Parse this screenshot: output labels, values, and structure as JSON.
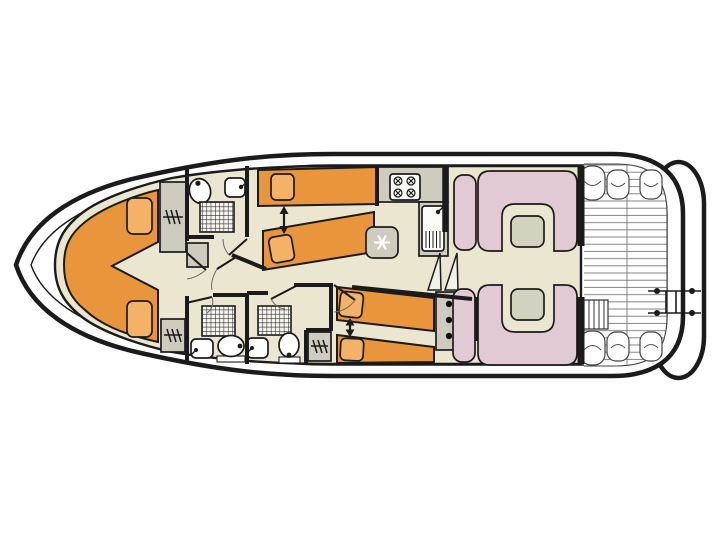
{
  "title": "motor-cruiser-deck-plan",
  "colors": {
    "outline": "#1b1b1b",
    "hull_fill": "#ffffff",
    "floor": "#EAE6D0",
    "deck": "#ffffff",
    "bed": "#E9953C",
    "pillow": "#F3B266",
    "furniture": "#CDCCBE",
    "appliance": "#FBFBF6",
    "seat": "#E2CAD5",
    "table": "#D3D2BE",
    "steps_fill": "#F2F1E8",
    "plank_line": "#777777",
    "snowflake": "#ffffff",
    "dot": "#111111"
  },
  "areas": {
    "bow_cabin": {
      "id": "bow-cabin",
      "fixtures": [
        "v-berth-double-bed",
        "pillow",
        "pillow",
        "wardrobe",
        "wardrobe",
        "step-cabinet"
      ]
    },
    "fore_bathroom": {
      "id": "fore-bathroom",
      "fixtures": [
        "toilet",
        "washbasin",
        "shower"
      ]
    },
    "port_mid_cabin": {
      "id": "port-mid-cabin",
      "fixtures": [
        "single-bed",
        "single-bed",
        "convertible-arrow"
      ]
    },
    "galley": {
      "id": "galley",
      "fixtures": [
        "four-burner-stove",
        "sink-with-drainer",
        "fridge-freezer",
        "worktop"
      ]
    },
    "aft_bathroom_port": {
      "id": "aft-bathroom-1",
      "fixtures": [
        "shower",
        "washbasin",
        "toilet"
      ]
    },
    "aft_bathroom_starboard": {
      "id": "aft-bathroom-2",
      "fixtures": [
        "shower",
        "washbasin",
        "toilet",
        "wardrobe"
      ]
    },
    "starboard_aft_cabin": {
      "id": "starboard-aft-cabin",
      "fixtures": [
        "single-bed",
        "single-bed",
        "convertible-arrow"
      ]
    },
    "helm": {
      "id": "helm-station",
      "fixtures": [
        "companionway-steps",
        "control-console",
        "steering-wheel"
      ]
    },
    "saloon": {
      "id": "saloon",
      "fixtures": [
        "u-shaped-dinette",
        "table",
        "u-shaped-dinette",
        "table"
      ]
    },
    "aft_deck": {
      "id": "aft-deck",
      "fixtures": [
        "plank-decking",
        "corner-seat",
        "corner-seat",
        "corner-seat",
        "corner-seat",
        "corner-seat",
        "corner-seat",
        "boarding-steps"
      ]
    },
    "swim_platform": {
      "id": "swim-platform",
      "fixtures": [
        "boarding-ladder"
      ]
    }
  },
  "icons": [
    "snowflake-icon",
    "stove-burner-icon",
    "wardrobe-hangers-icon",
    "door-swing-icon",
    "convertible-bed-arrow-icon"
  ]
}
